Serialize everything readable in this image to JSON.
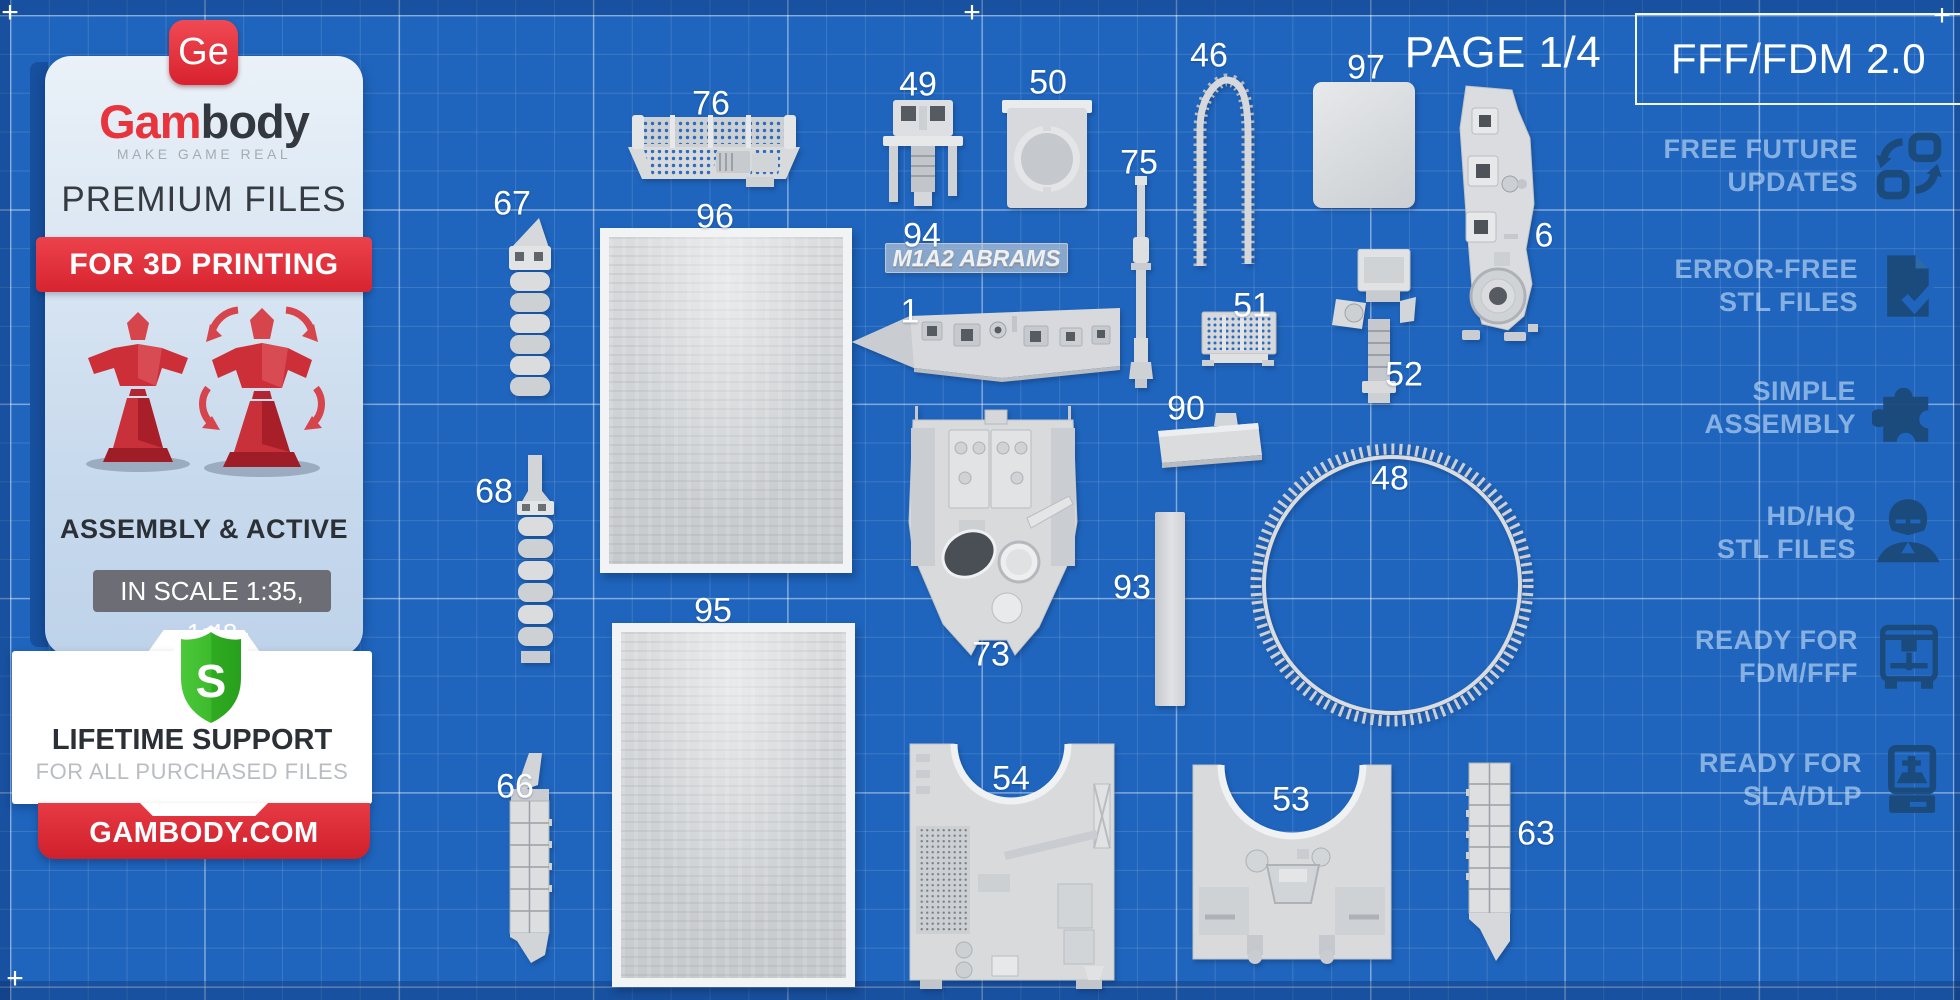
{
  "page": {
    "number_label": "PAGE 1/4",
    "format_label": "FFF/FDM 2.0"
  },
  "marks": {
    "plus": "+"
  },
  "sidebar": {
    "logo": "Ge",
    "brand_red": "Gam",
    "brand_dark": "body",
    "tagline": "MAKE GAME REAL",
    "title": "PREMIUM FILES",
    "ribbon": "FOR 3D PRINTING",
    "assembly": "ASSEMBLY & ACTIVE",
    "scale": "IN SCALE 1:35, 1:48",
    "shield_letter": "S",
    "support_title": "LIFETIME SUPPORT",
    "support_subtitle": "FOR ALL PURCHASED FILES",
    "website": "GAMBODY.COM"
  },
  "features": [
    {
      "line1": "FREE FUTURE",
      "line2": "UPDATES",
      "icon": "updates-icon"
    },
    {
      "line1": "ERROR-FREE",
      "line2": "STL FILES",
      "icon": "document-check-icon"
    },
    {
      "line1": "SIMPLE",
      "line2": "ASSEMBLY",
      "icon": "puzzle-icon"
    },
    {
      "line1": "HD/HQ",
      "line2": "STL FILES",
      "icon": "helmet-icon"
    },
    {
      "line1": "READY FOR",
      "line2": "FDM/FFF",
      "icon": "fdm-printer-icon"
    },
    {
      "line1": "READY FOR",
      "line2": "SLA/DLP",
      "icon": "sla-printer-icon"
    }
  ],
  "model_name": "M1A2 ABRAMS",
  "parts": [
    {
      "number": "76",
      "x": 711,
      "y": 104
    },
    {
      "number": "67",
      "x": 512,
      "y": 204
    },
    {
      "number": "96",
      "x": 715,
      "y": 217
    },
    {
      "number": "95",
      "x": 713,
      "y": 611
    },
    {
      "number": "49",
      "x": 918,
      "y": 85
    },
    {
      "number": "50",
      "x": 1048,
      "y": 83
    },
    {
      "number": "94",
      "x": 922,
      "y": 236
    },
    {
      "number": "1",
      "x": 910,
      "y": 312
    },
    {
      "number": "75",
      "x": 1139,
      "y": 163
    },
    {
      "number": "46",
      "x": 1209,
      "y": 56
    },
    {
      "number": "97",
      "x": 1366,
      "y": 68
    },
    {
      "number": "6",
      "x": 1544,
      "y": 236
    },
    {
      "number": "51",
      "x": 1252,
      "y": 306
    },
    {
      "number": "52",
      "x": 1404,
      "y": 375
    },
    {
      "number": "90",
      "x": 1186,
      "y": 409
    },
    {
      "number": "93",
      "x": 1132,
      "y": 588
    },
    {
      "number": "48",
      "x": 1390,
      "y": 479
    },
    {
      "number": "73",
      "x": 991,
      "y": 655
    },
    {
      "number": "68",
      "x": 494,
      "y": 492
    },
    {
      "number": "54",
      "x": 1011,
      "y": 779
    },
    {
      "number": "53",
      "x": 1291,
      "y": 800
    },
    {
      "number": "63",
      "x": 1536,
      "y": 834
    },
    {
      "number": "66",
      "x": 515,
      "y": 787
    }
  ],
  "colors": {
    "background": "#1f65bd",
    "accent_red": "#e2353f",
    "part_gray": "#d8dadc",
    "feature_text": "#8fb4e0",
    "icon_navy": "#1b4878",
    "shield_green": "#35b42a"
  }
}
